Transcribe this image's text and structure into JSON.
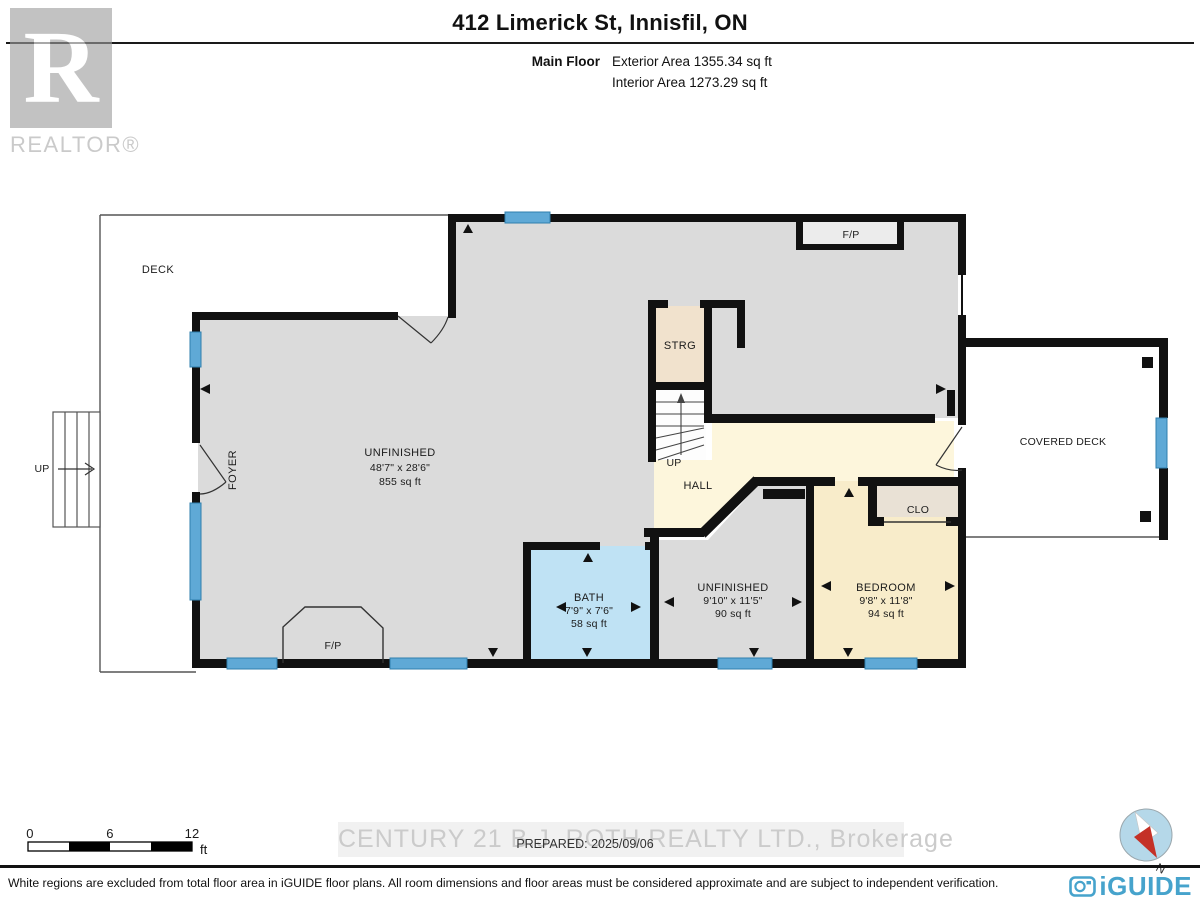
{
  "header": {
    "title": "412 Limerick St, Innisfil, ON",
    "floor_label": "Main Floor",
    "exterior_area": "Exterior Area 1355.34 sq ft",
    "interior_area": "Interior Area 1273.29 sq ft"
  },
  "watermarks": {
    "realtor_letter": "R",
    "realtor_text": "REALTOR®",
    "brokerage": "CENTURY 21 B.J. ROTH REALTY LTD., Brokerage"
  },
  "rooms": {
    "deck": {
      "label": "DECK"
    },
    "main_unfinished": {
      "label": "UNFINISHED",
      "dims": "48'7\" x 28'6\"",
      "area": "855 sq ft"
    },
    "foyer": {
      "label": "FOYER"
    },
    "strg": {
      "label": "STRG"
    },
    "stairs_up": {
      "label": "UP"
    },
    "deck_stairs_up": {
      "label": "UP"
    },
    "hall": {
      "label": "HALL"
    },
    "fp_top": {
      "label": "F/P"
    },
    "fp_bottom": {
      "label": "F/P"
    },
    "covered_deck": {
      "label": "COVERED DECK"
    },
    "clo": {
      "label": "CLO"
    },
    "bath": {
      "label": "BATH",
      "dims": "7'9\" x 7'6\"",
      "area": "58 sq ft"
    },
    "unfinished_small": {
      "label": "UNFINISHED",
      "dims": "9'10\" x 11'5\"",
      "area": "90 sq ft"
    },
    "bedroom": {
      "label": "BEDROOM",
      "dims": "9'8\" x 11'8\"",
      "area": "94 sq ft"
    }
  },
  "scale_bar": {
    "t0": "0",
    "t6": "6",
    "t12": "12",
    "unit": "ft"
  },
  "compass": {
    "north": "N"
  },
  "footer": {
    "prepared": "PREPARED: 2025/09/06",
    "disclaimer": "White regions are excluded from total floor area in iGUIDE floor plans. All room dimensions and floor areas must be considered approximate and are subject to independent verification.",
    "brand": "iGUIDE"
  },
  "colors": {
    "wall": "#111111",
    "window_blue": "#5fa9d6",
    "room_gray": "#dbdbdb",
    "hall_cream": "#fdf6dc",
    "bedroom_cream": "#f8ecca",
    "bath_blue": "#bfe2f4",
    "strg_tan": "#f1e2cd",
    "clo_tan": "#e9e1d5",
    "iguide_blue": "#46a3cc",
    "compass_red": "#c43127"
  }
}
